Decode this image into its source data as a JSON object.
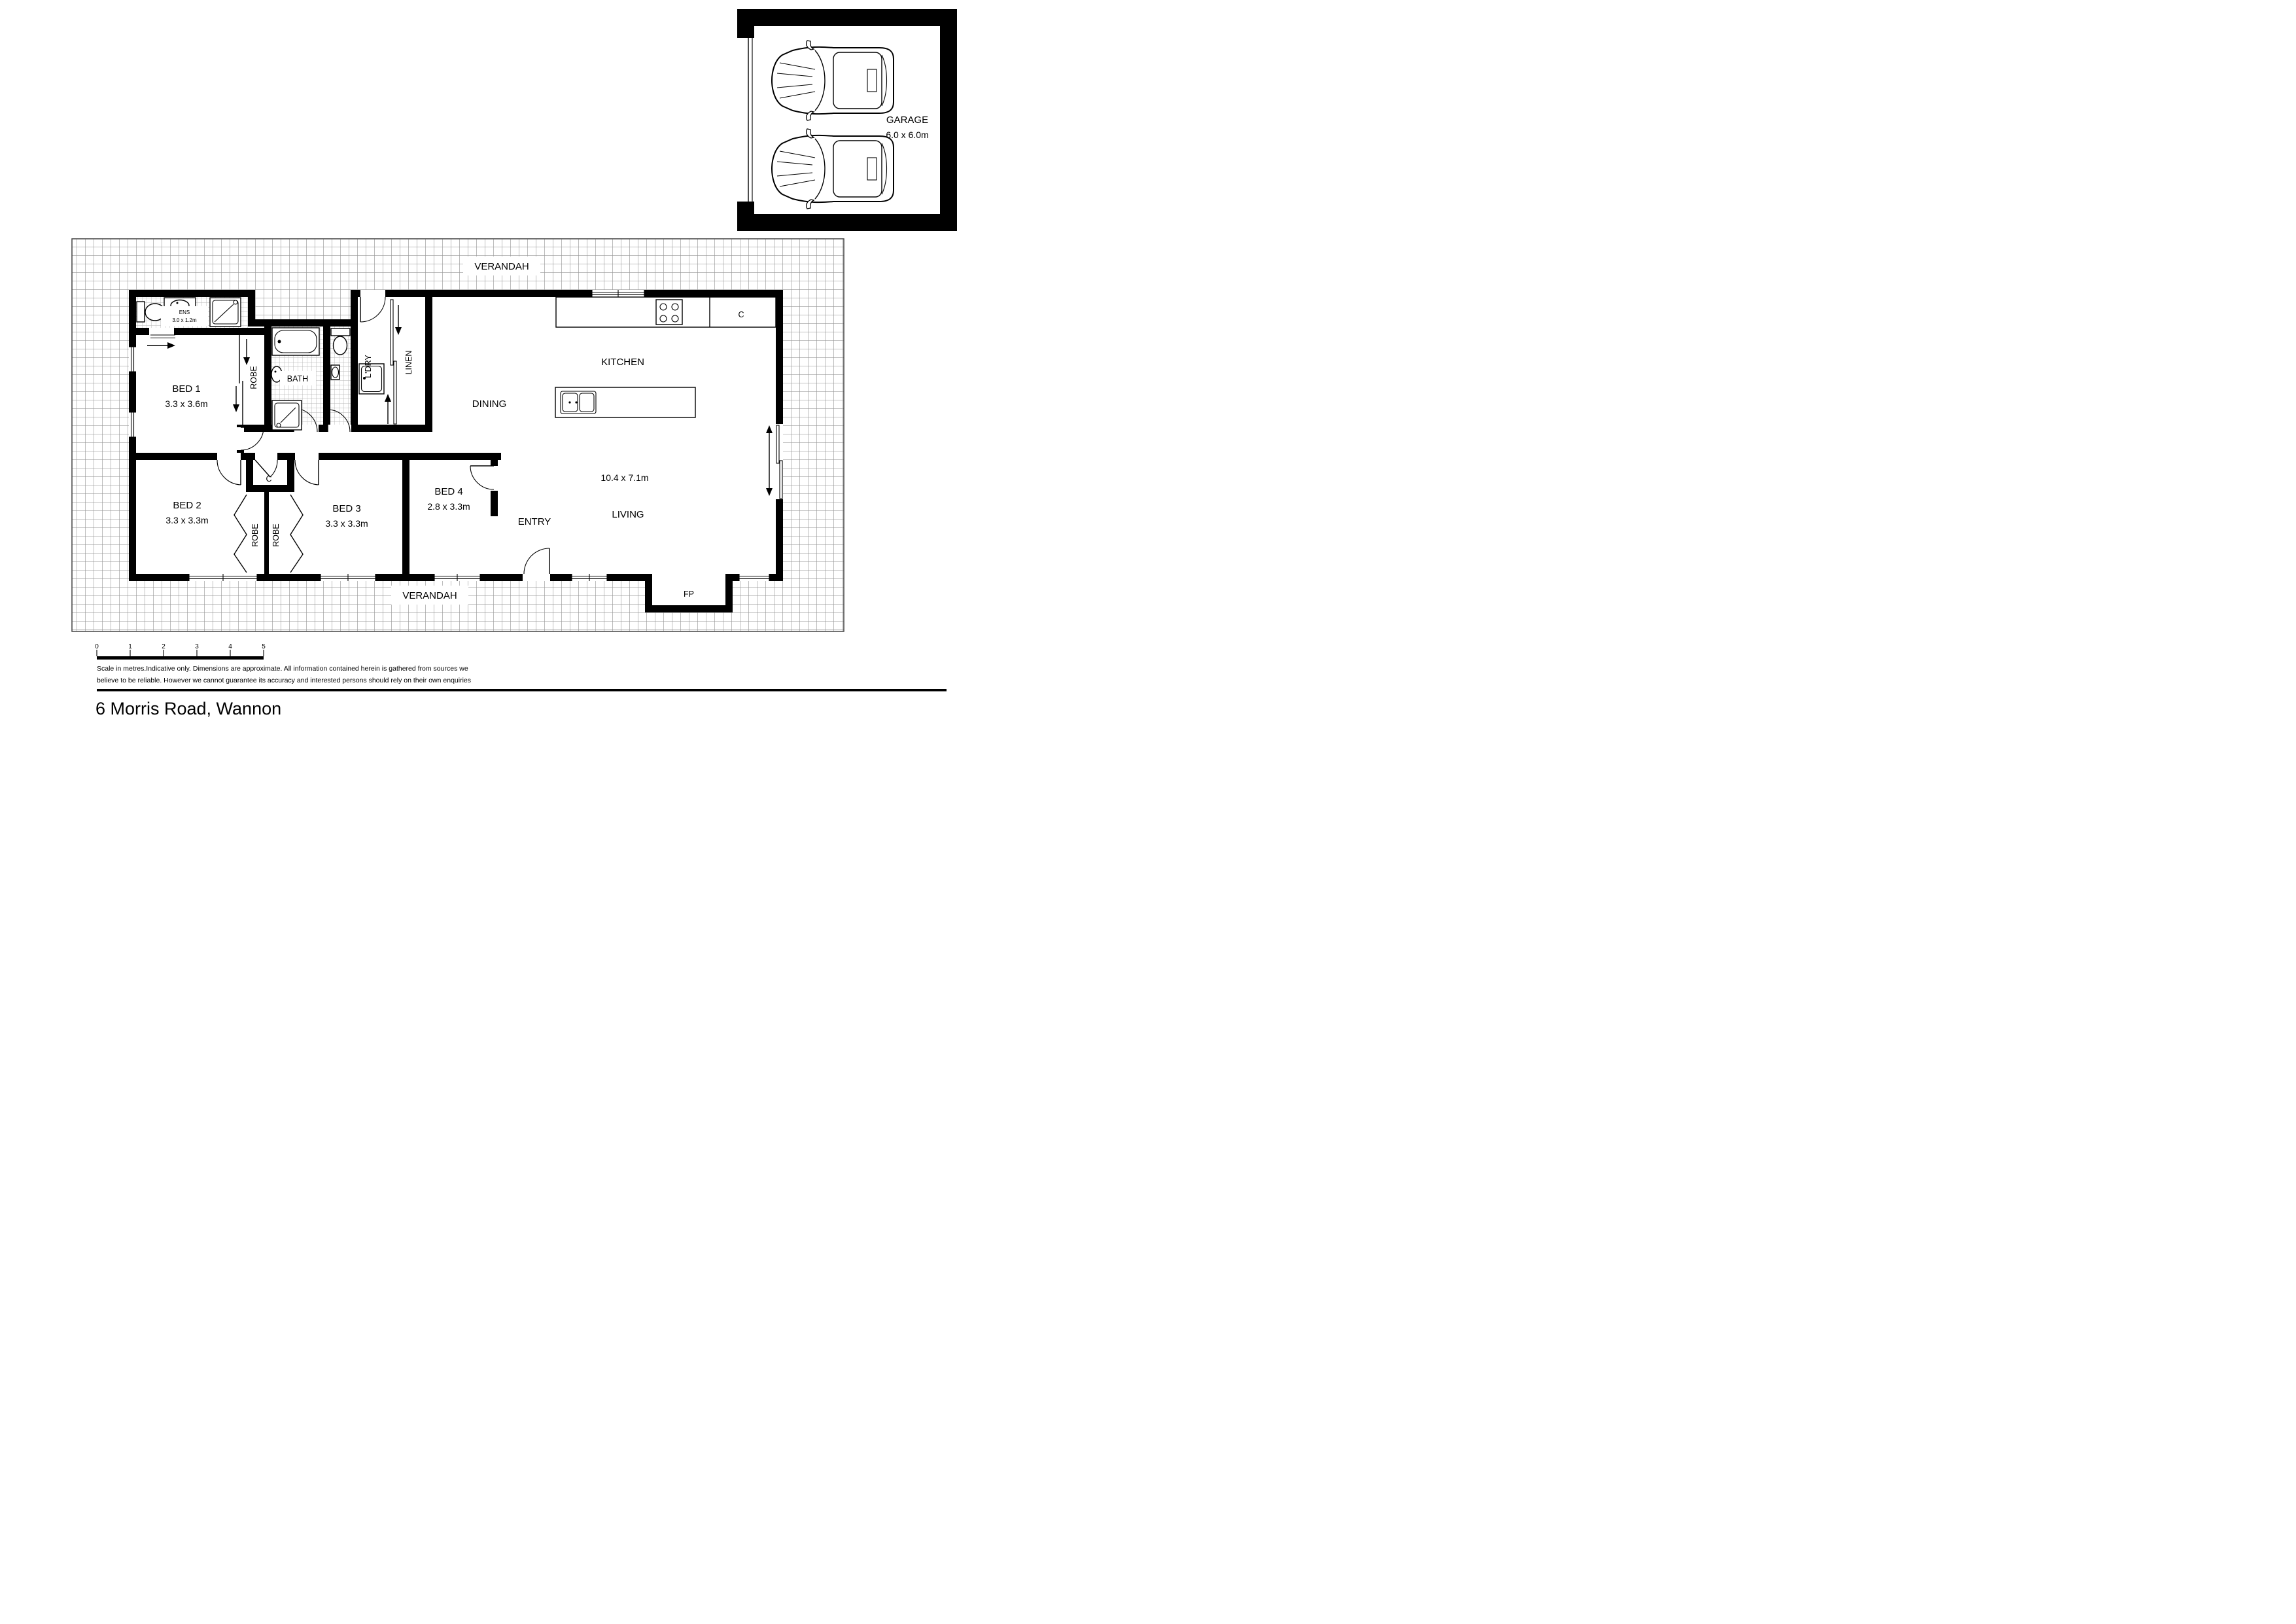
{
  "address": "6 Morris Road, Wannon",
  "disclaimer": {
    "line1": "Scale in metres.Indicative only. Dimensions are approximate. All information contained herein is gathered from sources we",
    "line2": "believe to be reliable. However we cannot guarantee its accuracy and interested persons should rely on their own enquiries"
  },
  "scale_bar": {
    "ticks": [
      "0",
      "1",
      "2",
      "3",
      "4",
      "5"
    ]
  },
  "garage": {
    "label": "GARAGE",
    "dims": "6.0 x 6.0m"
  },
  "verandah": {
    "top": "VERANDAH",
    "bottom": "VERANDAH"
  },
  "rooms": {
    "ens": {
      "label": "ENS",
      "dims": "3.0 x 1.2m"
    },
    "bed1": {
      "label": "BED 1",
      "dims": "3.3 x 3.6m"
    },
    "bed2": {
      "label": "BED 2",
      "dims": "3.3 x 3.3m"
    },
    "bed3": {
      "label": "BED 3",
      "dims": "3.3 x 3.3m"
    },
    "bed4": {
      "label": "BED 4",
      "dims": "2.8 x 3.3m"
    },
    "great_room": {
      "kitchen": "KITCHEN",
      "dining": "DINING",
      "living": "LIVING",
      "dims": "10.4 x 7.1m"
    },
    "entry": {
      "label": "ENTRY"
    },
    "bath": {
      "label": "BATH"
    },
    "laundry": {
      "label": "L'DRY"
    },
    "linen": {
      "label": "LINEN"
    },
    "robe_bed1": {
      "label": "ROBE"
    },
    "robe_bed2": {
      "label": "ROBE"
    },
    "robe_bed3": {
      "label": "ROBE"
    },
    "cupboard_hall": {
      "label": "C"
    },
    "cupboard_kitchen": {
      "label": "C"
    },
    "fireplace": {
      "label": "FP"
    }
  },
  "colors": {
    "walls": "#000000",
    "verandah_grid": "#999999",
    "tile_grid": "#b5b5b5"
  }
}
